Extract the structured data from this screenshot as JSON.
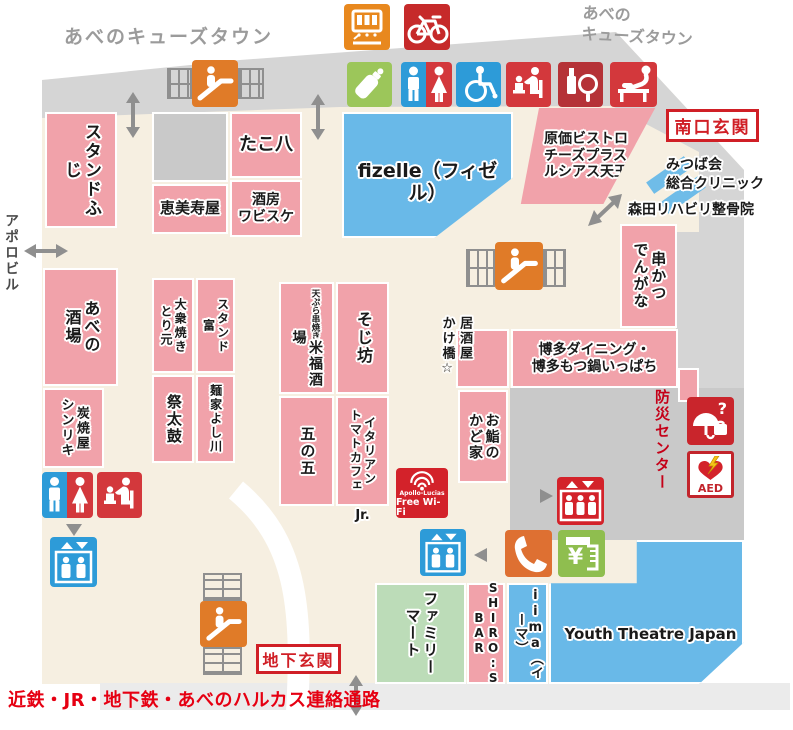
{
  "map": {
    "title_top_left": "あべのキューズタウン",
    "title_top_right": "あべの\nキューズタウン",
    "apollo_building": "アポロビル",
    "south_entrance": "南口玄関",
    "basement_entrance": "地下玄関",
    "clinic_mitsuba": "みつば会\n総合クリニック",
    "clinic_morita": "森田リハビリ整骨院",
    "disaster_center": "防災センター",
    "corridor_note": "近鉄・JR・地下鉄・あべのハルカス連絡通路",
    "wifi_line1": "Apollo-Lucias",
    "wifi_line2": "Free Wi-Fi",
    "aed_label": "AED"
  },
  "icons": {
    "atm_symbol": "¥",
    "lost_found_symbol": "?"
  },
  "shops": {
    "stand_fuji": "スタンドふじ",
    "takohachi": "たこ八",
    "ebisuya": "恵美寿屋",
    "shubo_wabisuke": "酒房\nワビスケ",
    "fizelle": "fizelle（フィゼル）",
    "genka_bistro": "原価ビストロ\nチーズプラス\nルシアス天王寺",
    "kushikatsu_dengana": "串かつ\nでんがな",
    "abeno_sakaba": "あべの\n酒場",
    "sumiyakiya_shinriki": "炭焼屋\nシンリキ",
    "taishu_yakitori_motoi": "大衆焼き\nとり元",
    "stand_tomi": "スタンド\n富",
    "matsuri_daiko": "祭太鼓",
    "menya_yoshikawa": "麺家よし川",
    "yonefuku_sub": "天ぷら串焼き",
    "yonefuku_sakaba": "米福酒場",
    "sojibo": "そじ坊",
    "go_no_go": "五の五",
    "italian_tomato_cafe": "イタリアン\nトマトカフェ",
    "italian_tomato_cafe_jr": "Jr.",
    "izakaya_kakehashi": "居酒屋\nかけ橋☆",
    "hakata_ippachi": "博多ダイニング・\n博多もつ鍋いっぱち",
    "osushi_no_kadoya": "お鮨の\nかど家",
    "family_mart": "ファミリー\nマート",
    "shiros_bar": "SHIRO:S BAR",
    "iima": "iima（イーマ）",
    "youth_theatre_japan": "Youth Theatre Japan"
  },
  "colors": {
    "shop_pink": "#F1A2AA",
    "shop_blue": "#69B9E8",
    "shop_green": "#BCDCB8",
    "corridor_gray": "#D5D5D5",
    "block_gray": "#C9C9C9",
    "floor_beige": "#F6EFE1",
    "accent_red": "#D01F26",
    "icon_orange": "#E07B28",
    "icon_blue": "#2D9BD8",
    "icon_green": "#8FBE4F",
    "text_gray": "#9B9B9B"
  }
}
